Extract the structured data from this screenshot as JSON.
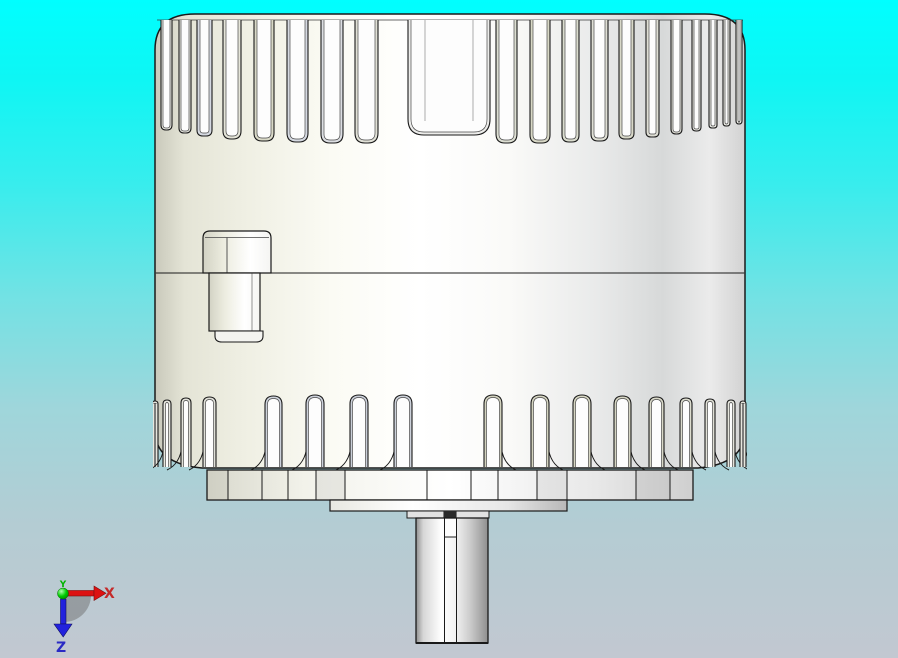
{
  "viewport": {
    "description": "CAD 3D viewport showing finned motor housing, front view"
  },
  "background": {
    "top_color": "#00ffff",
    "mid_color": "#72e2e4",
    "bottom_color": "#c2c8d1"
  },
  "model": {
    "outline_color": "#1a1a1a",
    "body_white": "#ffffff",
    "ivory_shade": "#e0e0d0",
    "blue_gray_shade": "#ccd1da",
    "top_fin_slots": 20,
    "bottom_fins": 17
  },
  "axis_triad": {
    "x_label": "X",
    "y_label": "Y",
    "z_label": "Z",
    "x_color": "#c42a2a",
    "y_color": "#00b400",
    "z_color": "#2a2ac4",
    "shadow_color": "#707070"
  }
}
